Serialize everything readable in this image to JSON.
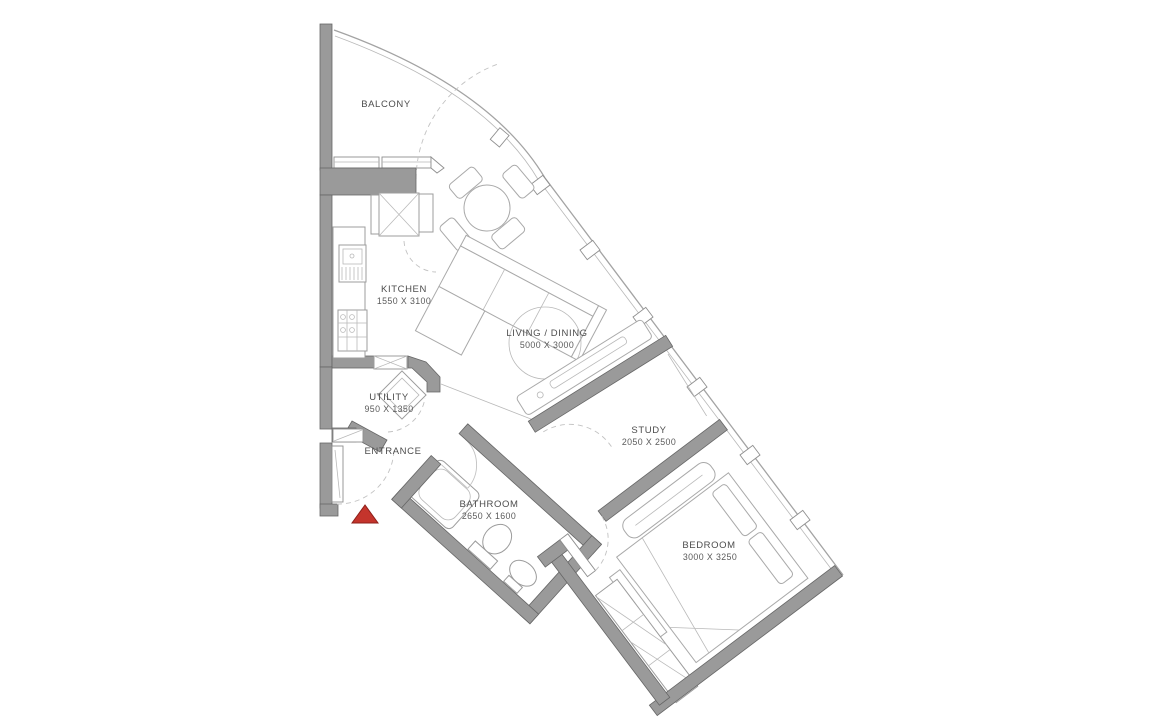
{
  "plan": {
    "title": "apartment-floor-plan",
    "rooms": {
      "balcony": {
        "name": "BALCONY",
        "dims": ""
      },
      "kitchen": {
        "name": "KITCHEN",
        "dims": "1550 X 3100"
      },
      "living": {
        "name": "LIVING / DINING",
        "dims": "5000 X 3000"
      },
      "utility": {
        "name": "UTILITY",
        "dims": "950 X 1350"
      },
      "entrance": {
        "name": "ENTRANCE",
        "dims": ""
      },
      "bathroom": {
        "name": "BATHROOM",
        "dims": "2650 X 1600"
      },
      "study": {
        "name": "STUDY",
        "dims": "2050 X 2500"
      },
      "bedroom": {
        "name": "BEDROOM",
        "dims": "3000 X 3250"
      }
    },
    "colors": {
      "wall": "#9a9a9a",
      "entry_marker": "#c4342c",
      "background": "#ffffff"
    }
  }
}
